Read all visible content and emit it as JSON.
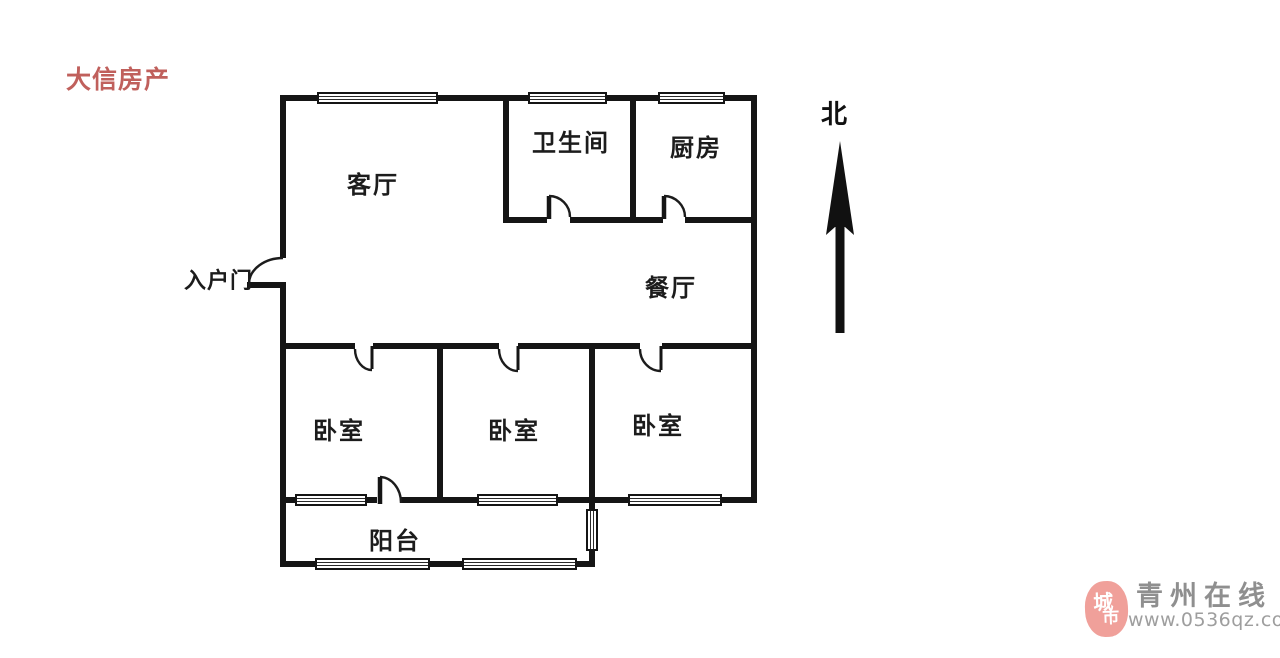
{
  "page": {
    "background": "#ffffff",
    "wall_color": "#151515"
  },
  "agency_watermark": {
    "text": "大信房产",
    "color": "#c0605c"
  },
  "floorplan": {
    "rooms": {
      "living_room": "客厅",
      "bathroom": "卫生间",
      "kitchen": "厨房",
      "dining_room": "餐厅",
      "bedroom1": "卧室",
      "bedroom2": "卧室",
      "bedroom3": "卧室",
      "balcony": "阳台"
    },
    "entrance_label": "入户门",
    "compass_label": "北"
  },
  "site_watermark": {
    "seal_char_top": "城",
    "seal_char_bottom": "市",
    "seal_color": "#f0a09a",
    "site_name": "青州在线",
    "site_url": "www.0536qz.com",
    "text_color": "#8f8f8f"
  }
}
